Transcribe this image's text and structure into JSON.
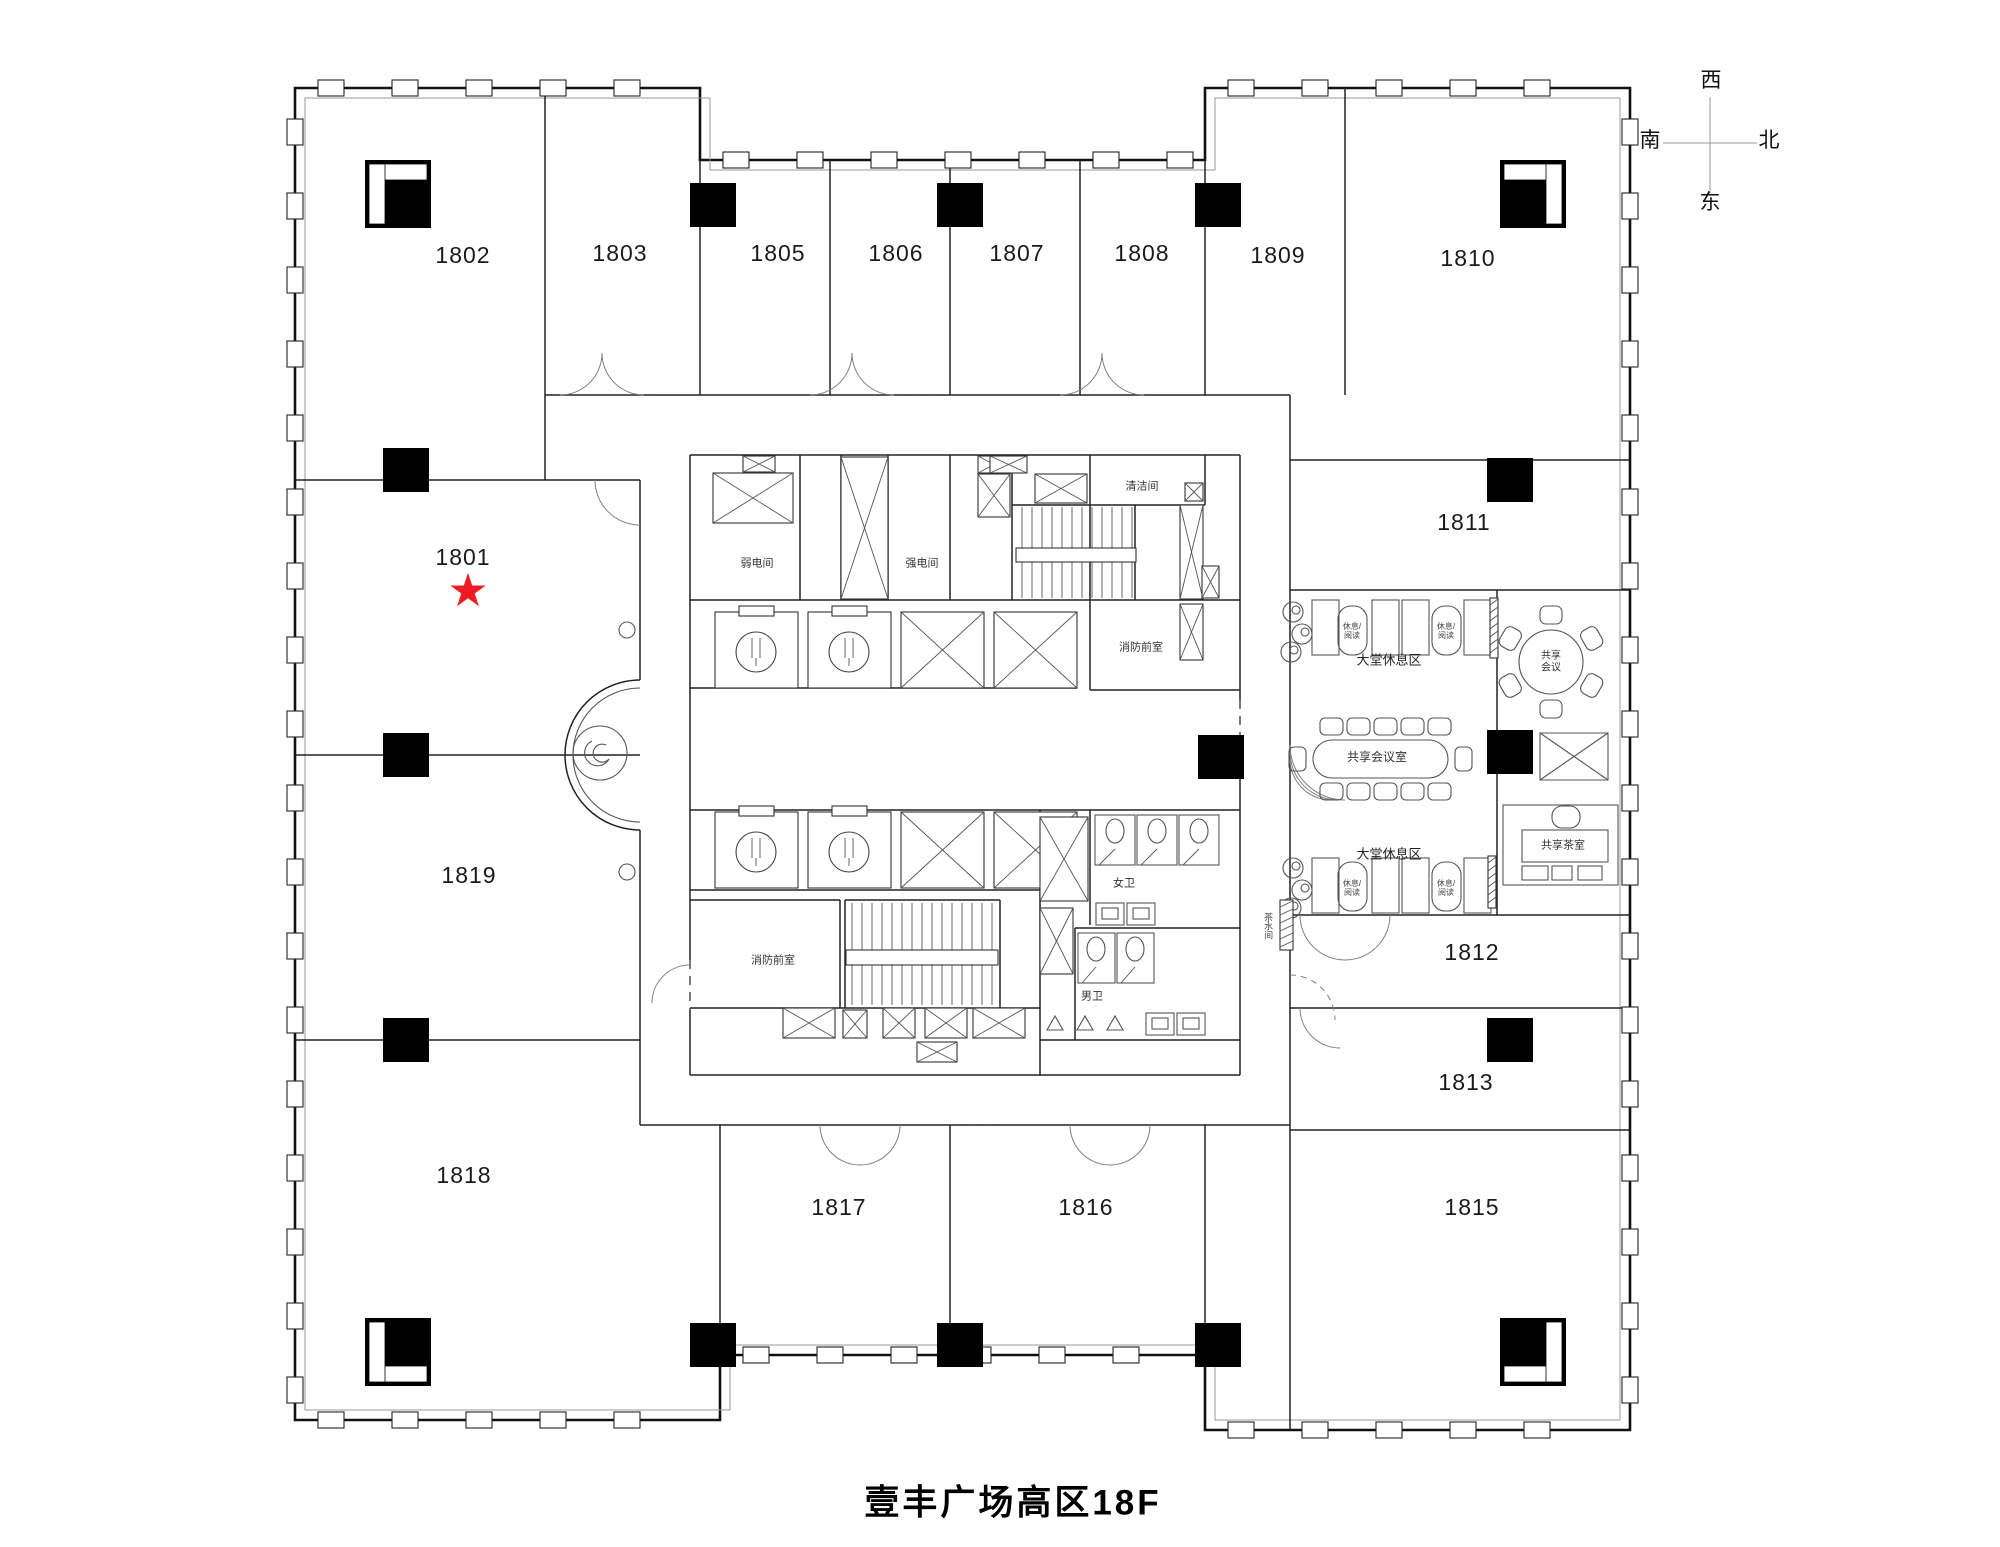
{
  "title": "壹丰广场高区18F",
  "compass": {
    "top": "西",
    "left": "南",
    "right": "北",
    "bottom": "东"
  },
  "highlight": {
    "unit": "1801",
    "glyph": "★",
    "color": "#ed1c24"
  },
  "units": {
    "u1801": {
      "label": "1801"
    },
    "u1802": {
      "label": "1802"
    },
    "u1803": {
      "label": "1803"
    },
    "u1805": {
      "label": "1805"
    },
    "u1806": {
      "label": "1806"
    },
    "u1807": {
      "label": "1807"
    },
    "u1808": {
      "label": "1808"
    },
    "u1809": {
      "label": "1809"
    },
    "u1810": {
      "label": "1810"
    },
    "u1811": {
      "label": "1811"
    },
    "u1812": {
      "label": "1812"
    },
    "u1813": {
      "label": "1813"
    },
    "u1815": {
      "label": "1815"
    },
    "u1816": {
      "label": "1816"
    },
    "u1817": {
      "label": "1817"
    },
    "u1818": {
      "label": "1818"
    },
    "u1819": {
      "label": "1819"
    }
  },
  "core": {
    "weak_power_room": "弱电间",
    "strong_power_room": "强电间",
    "cleaning_room": "清洁间",
    "fire_lobby_upper": "消防前室",
    "fire_lobby_lower": "消防前室",
    "female_toilet": "女卫",
    "male_toilet": "男卫",
    "pantry": "茶水间"
  },
  "amenity": {
    "lobby_lounge_upper": "大堂休息区",
    "lobby_lounge_lower": "大堂休息区",
    "rest_reading_line1": "休息/",
    "rest_reading_line2": "阅读",
    "shared_meeting_line1": "共享",
    "shared_meeting_line2": "会议",
    "shared_meeting_room": "共享会议室",
    "shared_tea_room": "共享茶室"
  }
}
